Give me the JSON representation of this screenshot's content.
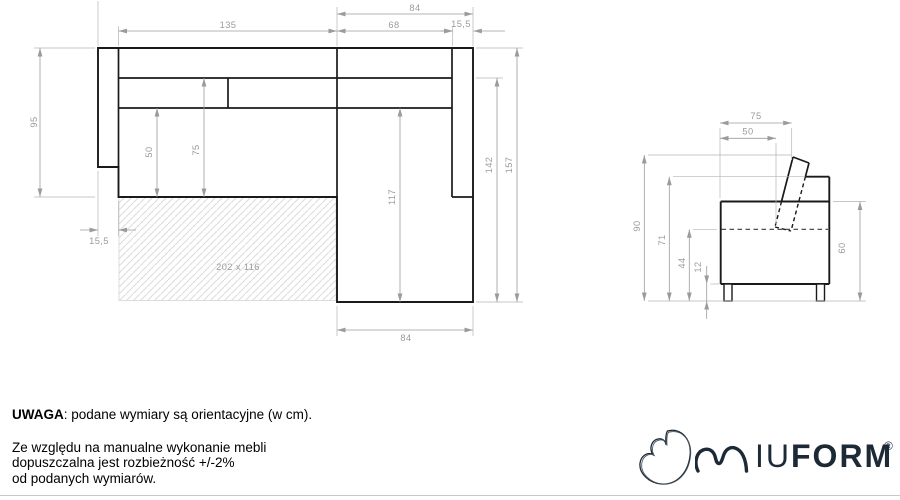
{
  "top_view": {
    "width_top": "84",
    "seat_width": "135",
    "chaise_inner_width": "68",
    "right_armrest_width": "15,5",
    "body_depth": "95",
    "left_armrest_width": "15,5",
    "seat_depth_inner": "50",
    "seat_depth_outer": "75",
    "chaise_inner_length": "117",
    "chaise_length": "142",
    "total_length": "157",
    "width_bottom": "84",
    "sleeping_area": "202 x 116"
  },
  "side_view": {
    "backrest_top_depth": "75",
    "backrest_seat_depth": "50",
    "total_height": "90",
    "frame_height": "71",
    "seat_height": "44",
    "leg_height": "12",
    "side_height": "60"
  },
  "notes": {
    "warning_label": "UWAGA",
    "warning_text": ": podane wymiary są orientacyjne (w cm).",
    "tolerance_line1": "Ze względu na manualne wykonanie mebli",
    "tolerance_line2": "dopuszczalna jest rozbieżność +/-2%",
    "tolerance_line3": "od podanych wymiarów."
  },
  "logo": {
    "wordmark_light": "IU",
    "wordmark_bold": "FORM",
    "registered": "®"
  },
  "colors": {
    "outline": "#1a1a1a",
    "dimension": "#9b9b9b",
    "logo": "#1c2936"
  }
}
